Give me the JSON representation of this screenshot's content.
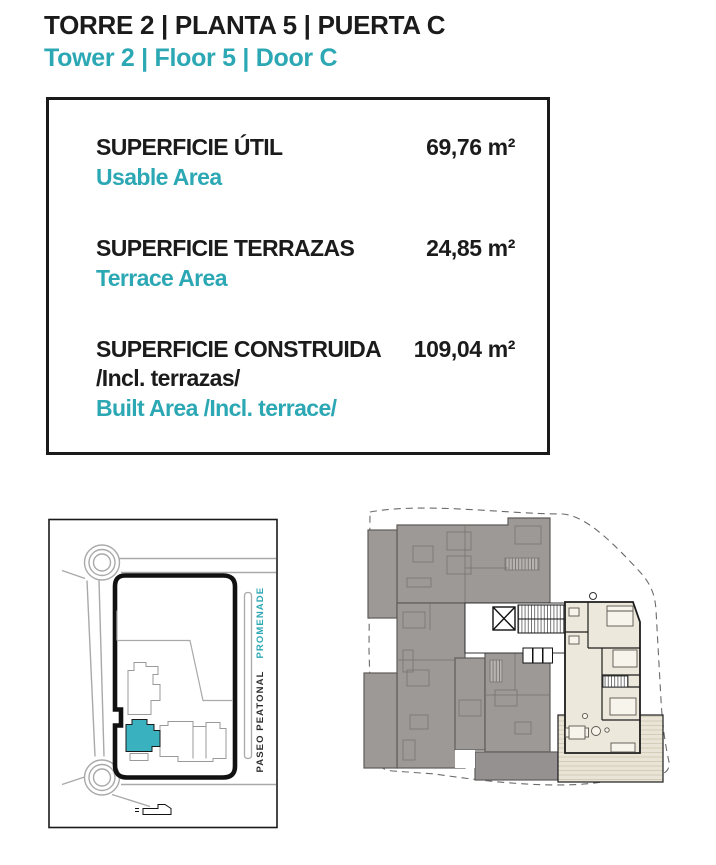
{
  "header": {
    "title_es": "TORRE 2 | PLANTA 5 | PUERTA C",
    "title_en": "Tower 2 | Floor 5 | Door C"
  },
  "area_box": {
    "rows": [
      {
        "label_es": "SUPERFICIE ÚTIL",
        "label_en": "Usable Area",
        "value": "69,76 m²"
      },
      {
        "label_es": "SUPERFICIE TERRAZAS",
        "label_en": "Terrace Area",
        "value": "24,85 m²"
      },
      {
        "label_es": "SUPERFICIE CONSTRUIDA",
        "label_es_sub": "/Incl. terrazas/",
        "label_en": "Built Area /Incl. terrace/",
        "value": "109,04 m²"
      }
    ]
  },
  "site_map": {
    "label_promenade": "PROMENADE",
    "label_paseo": "PASEO PEATONAL",
    "highlight_building_color": "#3ab1be"
  },
  "floor_plan": {
    "unit_fill_color": "#ece8db",
    "neighbor_fill_color": "#9d9996"
  },
  "colors": {
    "accent_teal": "#2ca8b4",
    "text_black": "#1b1b1b"
  }
}
